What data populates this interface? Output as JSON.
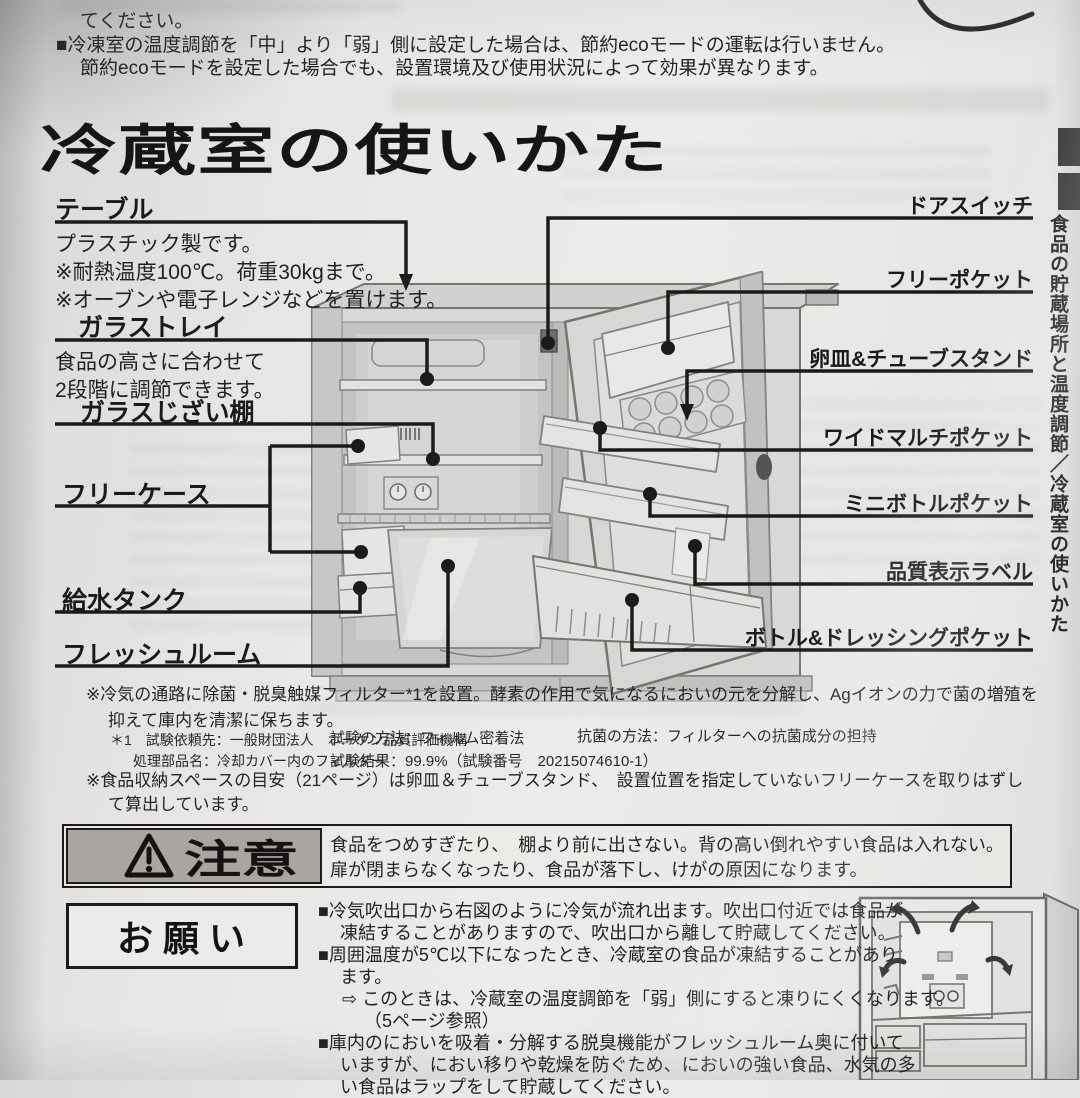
{
  "colors": {
    "paper": "#e7e6e4",
    "ink": "#1c1b1a",
    "caution_bg": "#a9a6a2",
    "line_gray": "#84827e"
  },
  "top_block": {
    "line1": "てください。",
    "line2": "■冷凍室の温度調節を「中」より「弱」側に設定した場合は、節約ecoモードの運転は行いません。",
    "line3": "節約ecoモードを設定した場合でも、設置環境及び使用状況によって効果が異なります。"
  },
  "heading": "冷蔵室の使いかた",
  "side_tab": "食品の貯蔵場所と温度調節／冷蔵室の使いかた",
  "diagram": {
    "left_labels": [
      {
        "label": "テーブル",
        "desc1": "プラスチック製です。",
        "desc2": "※耐熱温度100℃。荷重30kgまで。",
        "desc3": "※オーブンや電子レンジなどを置けます。"
      },
      {
        "label": "ガラストレイ",
        "desc1": "食品の高さに合わせて",
        "desc2": "2段階に調節できます。"
      },
      {
        "label": "ガラスじざい棚"
      },
      {
        "label": "フリーケース"
      },
      {
        "label": "給水タンク"
      },
      {
        "label": "フレッシュルーム"
      }
    ],
    "right_labels": [
      {
        "label": "ドアスイッチ"
      },
      {
        "label": "フリーポケット"
      },
      {
        "label": "卵皿&チューブスタンド"
      },
      {
        "label": "ワイドマルチポケット"
      },
      {
        "label": "ミニボトルポケット"
      },
      {
        "label": "品質表示ラベル"
      },
      {
        "label": "ボトル&ドレッシングポケット"
      }
    ]
  },
  "notes": {
    "filter_line1": "※冷気の通路に除菌・脱臭触媒フィルター*1を設置。酵素の作用で気になるにおいの元を分解し、Agイオンの力で菌の増殖を",
    "filter_line2": "抑えて庫内を清潔に保ちます。",
    "test_col1_line1": "＊1　試験依頼先：一般財団法人　ボーケン品質評価機構",
    "test_col1_line2": "処理部品名：冷却カバー内のフィルター",
    "test_col2_line1": "試験の方法：フィルム密着法",
    "test_col2_line2": "試験結果：99.9%（試験番号　20215074610-1）",
    "test_col3_line1": "抗菌の方法：フィルターへの抗菌成分の担持",
    "storage_line1": "※食品収納スペースの目安（21ページ）は卵皿＆チューブスタンド、　設置位置を指定していないフリーケースを取りはずし",
    "storage_line2": "て算出しています。"
  },
  "caution": {
    "title": "注意",
    "line1": "食品をつめすぎたり、　棚より前に出さない。背の高い倒れやすい食品は入れない。",
    "line2": "扉が閉まらなくなったり、食品が落下し、けがの原因になります。"
  },
  "request": {
    "title": "お願い",
    "lines": [
      "■冷気吹出口から右図のように冷気が流れ出ます。吹出口付近では食品が",
      "凍結することがありますので、吹出口から離して貯蔵してください。",
      "■周囲温度が5℃以下になったとき、冷蔵室の食品が凍結することがあり",
      "ます。",
      "⇨ このときは、冷蔵室の温度調節を「弱」側にすると凍りにくくなります。",
      "（5ページ参照）",
      "■庫内のにおいを吸着・分解する脱臭機能がフレッシュルーム奥に付いて",
      "いますが、におい移りや乾燥を防ぐため、においの強い食品、水気の多",
      "い食品はラップをして貯蔵してください。"
    ]
  }
}
